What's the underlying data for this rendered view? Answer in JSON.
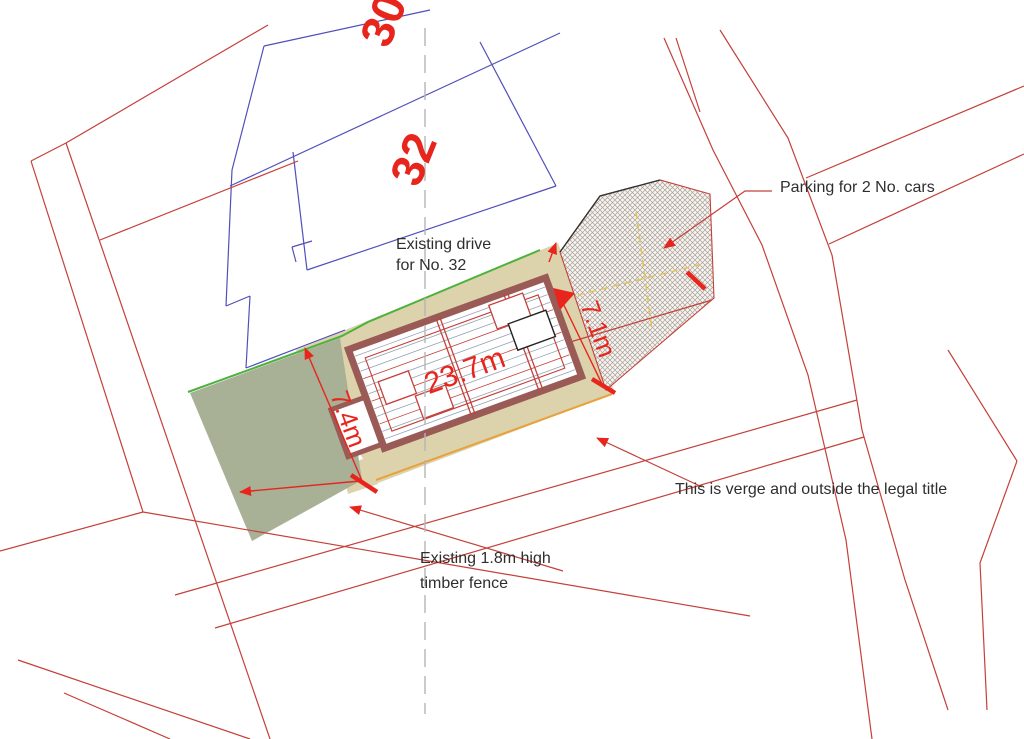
{
  "drawing": {
    "type": "architectural site plan",
    "labels": {
      "house_number_back": "30",
      "house_number_front": "32",
      "existing_drive_line1": "Existing drive",
      "existing_drive_line2": "for No. 32",
      "parking_note": "Parking for 2 No. cars",
      "verge_note": "This is verge and outside the legal title",
      "fence_note_line1": "Existing 1.8m high",
      "fence_note_line2": "timber fence"
    },
    "dimensions": {
      "building_length": "23.7m",
      "plot_width": "7.4m",
      "parking_depth": "7.1m"
    },
    "colors": {
      "boundary_red": "#c4403a",
      "dimension_red": "#e8251d",
      "parcel_blue": "#5050bb",
      "plot_tan": "#dcd3ac",
      "garden_sage": "#a8b096",
      "boundary_green": "#4db23c",
      "edge_orange": "#e8a23d",
      "bay_yellow": "#e0c45c",
      "wall_maroon": "#9a5a55",
      "centerline_gray": "#b5b5b5",
      "annotation_black": "#2e2e2e"
    }
  }
}
